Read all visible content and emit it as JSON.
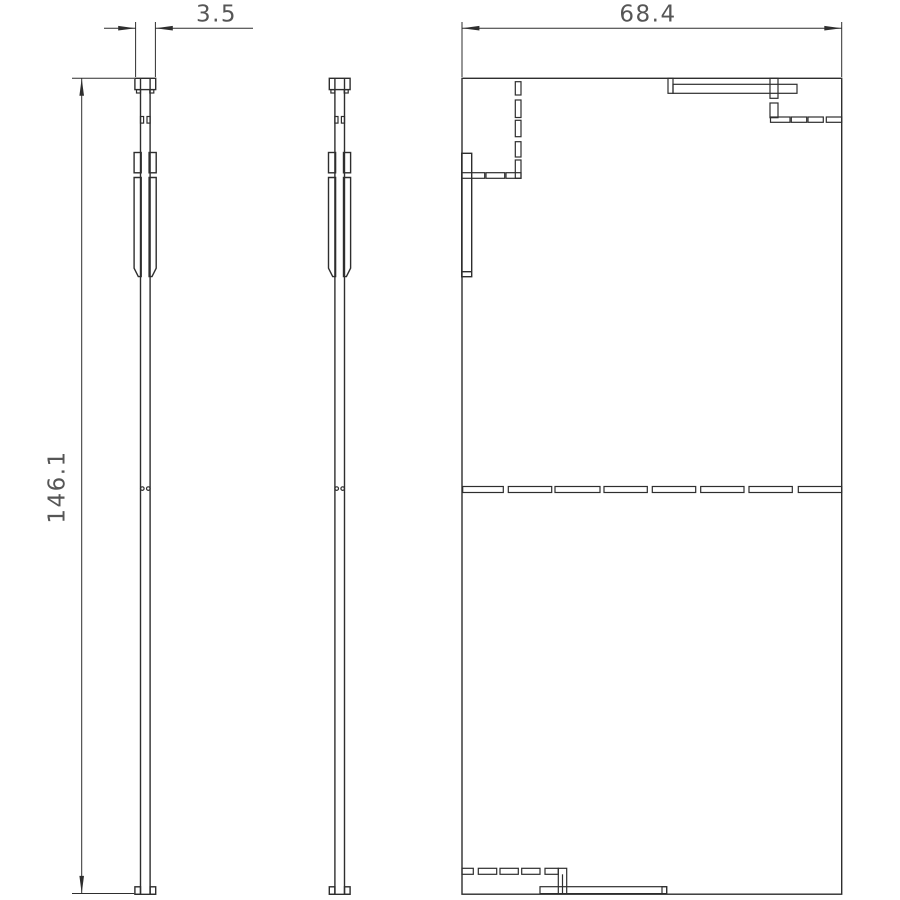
{
  "drawing": {
    "type": "multi-view technical drawing",
    "dimensions": {
      "thickness": {
        "label": "3.5"
      },
      "width": {
        "label": "68.4"
      },
      "height": {
        "label": "146.1"
      }
    },
    "colors": {
      "background": "#ffffff",
      "line": "#2e2e2e",
      "dimension_text": "#565656"
    }
  }
}
